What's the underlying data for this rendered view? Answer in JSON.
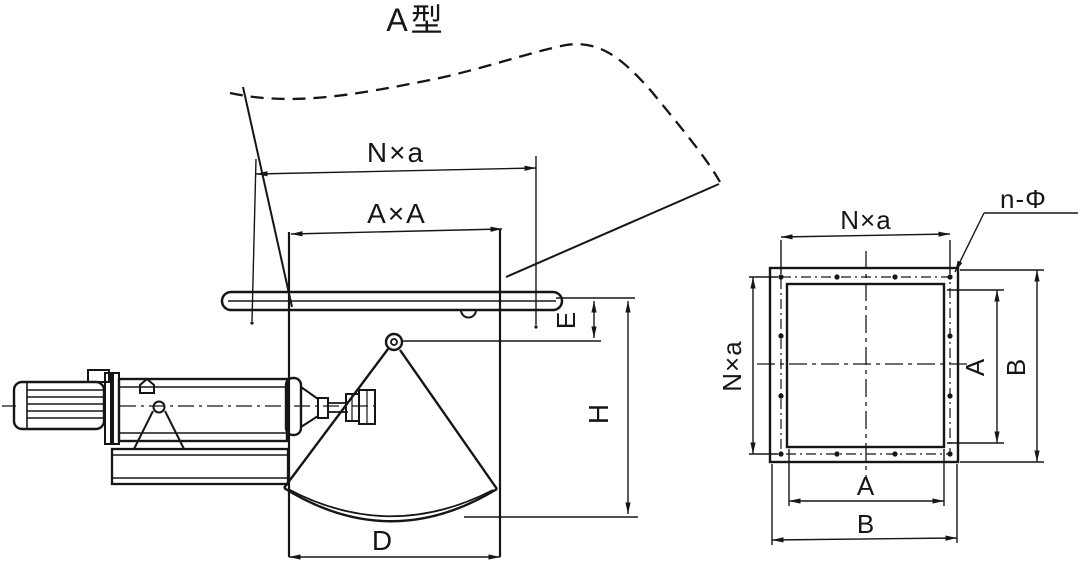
{
  "title": "A型",
  "colors": {
    "ink": "#161616",
    "paper": "#ffffff"
  },
  "front_view": {
    "dim_flange_bolt_span": "N×a",
    "dim_opening": "A×A",
    "dim_offset_e": "E",
    "dim_height_h": "H",
    "dim_gate_width_d": "D"
  },
  "flange_view": {
    "dim_bolt_span_horizontal": "N×a",
    "dim_bolt_span_vertical": "N×a",
    "bolt_holes_label": "n-Φ",
    "dim_opening_width": "A",
    "dim_opening_height": "A",
    "dim_outer_width": "B",
    "dim_outer_height": "B"
  }
}
